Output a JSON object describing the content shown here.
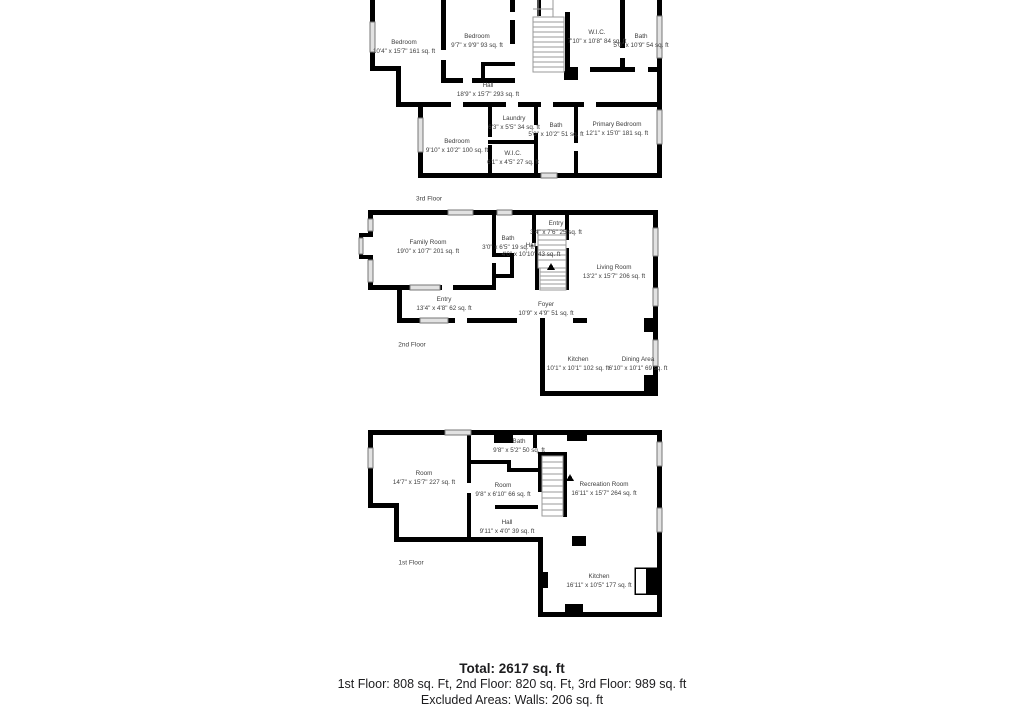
{
  "colors": {
    "wall": "#000000",
    "window_fill": "#e2e2e2",
    "stair_stroke": "#9a9a9a",
    "label_text": "#3d3d3d",
    "summary_text": "#1d1d1f"
  },
  "floors": [
    {
      "caption": "3rd Floor",
      "rooms": [
        {
          "name": "Bedroom",
          "dims": "10'4\" x 15'7\"",
          "area": "161 sq. ft"
        },
        {
          "name": "Bedroom",
          "dims": "9'7\" x 9'9\"",
          "area": "93 sq. ft"
        },
        {
          "name": "W.I.C.",
          "dims": "7'10\" x 10'8\"",
          "area": "84 sq. ft"
        },
        {
          "name": "Bath",
          "dims": "5'0\" x 10'9\"",
          "area": "54 sq. ft"
        },
        {
          "name": "Hall",
          "dims": "18'9\" x 15'7\"",
          "area": "293 sq. ft"
        },
        {
          "name": "Laundry",
          "dims": "6'3\" x 5'5\"",
          "area": "34 sq. ft"
        },
        {
          "name": "Bath",
          "dims": "5'0\" x 10'2\"",
          "area": "51 sq. ft"
        },
        {
          "name": "Bedroom",
          "dims": "9'10\" x 10'2\"",
          "area": "100 sq. ft"
        },
        {
          "name": "W.I.C.",
          "dims": "6'1\" x 4'5\"",
          "area": "27 sq. ft"
        },
        {
          "name": "Primary Bedroom",
          "dims": "12'1\" x 15'0\"",
          "area": "181 sq. ft"
        }
      ]
    },
    {
      "caption": "2nd Floor",
      "rooms": [
        {
          "name": "Family Room",
          "dims": "19'0\" x 10'7\"",
          "area": "201 sq. ft"
        },
        {
          "name": "Bath",
          "dims": "3'0\" x 6'5\"",
          "area": "19 sq. ft"
        },
        {
          "name": "Entry",
          "dims": "3'4\" x 7'6\"",
          "area": "25 sq. ft"
        },
        {
          "name": "Hall",
          "dims": "4'0\" x 10'10\"",
          "area": "43 sq. ft"
        },
        {
          "name": "Living Room",
          "dims": "13'2\" x 15'7\"",
          "area": "206 sq. ft"
        },
        {
          "name": "Entry",
          "dims": "13'4\" x 4'8\"",
          "area": "62 sq. ft"
        },
        {
          "name": "Foyer",
          "dims": "10'9\" x 4'9\"",
          "area": "51 sq. ft"
        },
        {
          "name": "Kitchen",
          "dims": "10'1\" x 10'1\"",
          "area": "102 sq. ft"
        },
        {
          "name": "Dining Area",
          "dims": "6'10\" x 10'1\"",
          "area": "69 sq. ft"
        }
      ]
    },
    {
      "caption": "1st Floor",
      "rooms": [
        {
          "name": "Room",
          "dims": "14'7\" x 15'7\"",
          "area": "227 sq. ft"
        },
        {
          "name": "Bath",
          "dims": "9'8\" x 5'2\"",
          "area": "50 sq. ft"
        },
        {
          "name": "Room",
          "dims": "9'8\" x 6'10\"",
          "area": "66 sq. ft"
        },
        {
          "name": "Recreation Room",
          "dims": "16'11\" x 15'7\"",
          "area": "264 sq. ft"
        },
        {
          "name": "Hall",
          "dims": "9'11\" x 4'0\"",
          "area": "39 sq. ft"
        },
        {
          "name": "Kitchen",
          "dims": "16'11\" x 10'5\"",
          "area": "177 sq. ft"
        }
      ]
    }
  ],
  "summary": {
    "total": "Total: 2617 sq. ft",
    "floor_breakdown": "1st Floor: 808 sq. Ft, 2nd Floor: 820 sq. Ft, 3rd Floor: 989 sq. ft",
    "excluded": "Excluded Areas: Walls: 206 sq. ft"
  }
}
